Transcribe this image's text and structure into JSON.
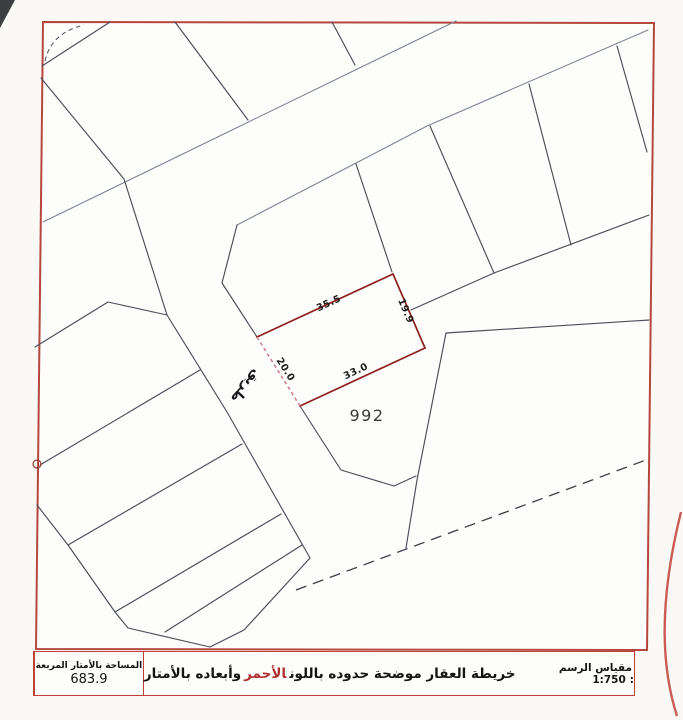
{
  "map": {
    "road_label": "طريق",
    "plot": {
      "number": "992",
      "dim_top": "35.5",
      "dim_right": "19.9",
      "dim_left": "20.0",
      "dim_bottom": "33.0"
    }
  },
  "footer": {
    "area_label": "المساحة بالأمتار المربعة",
    "area_value": "683.9",
    "note_before": "خريطة العقار موضحة حدوده باللون",
    "note_red": "الأحمر",
    "note_after": "وأبعاده بالأمتار",
    "scale_label": "مقياس الرسم :",
    "scale_value": "1:750"
  },
  "colors": {
    "border_red": "#b5473e",
    "table_red": "#bf4238",
    "plot_red": "#8e1f1f",
    "plot_red_light": "#d4768a",
    "accent_text_red": "#b03030",
    "line_dark": "#4b4d58",
    "line_light": "#7c8391"
  }
}
